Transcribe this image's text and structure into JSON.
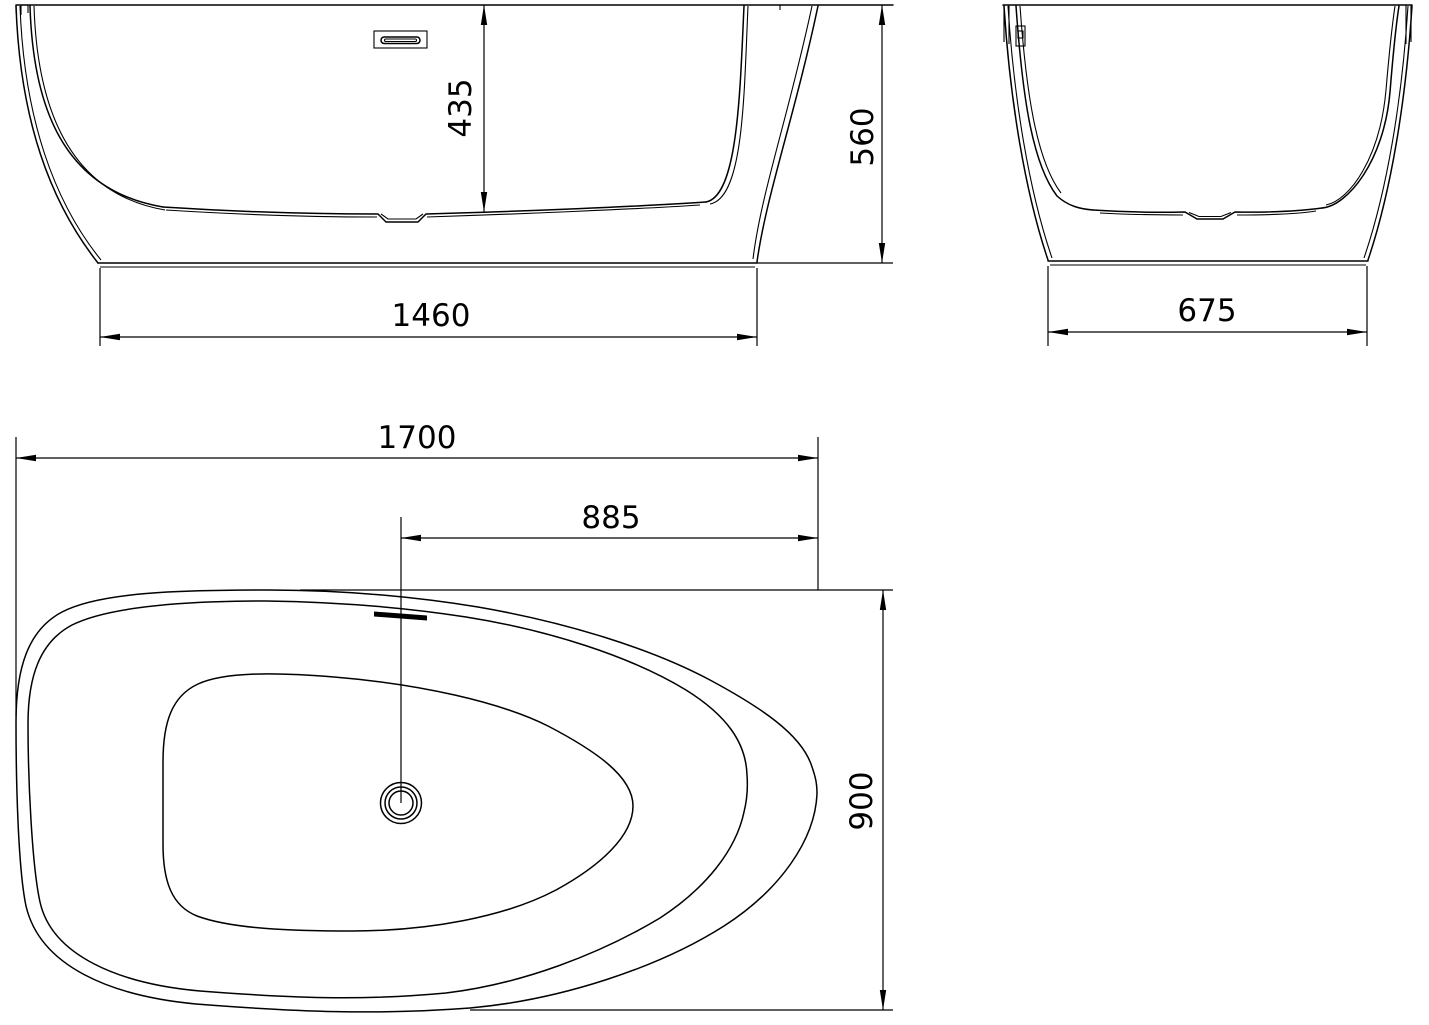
{
  "page": {
    "background": "#ffffff",
    "line_color": "#000000"
  },
  "dimensions": {
    "side_view": {
      "rim_to_floor_depth": "435",
      "overall_height": "560",
      "base_length": "1460"
    },
    "end_view": {
      "base_width": "675"
    },
    "plan_view": {
      "overall_length": "1700",
      "overflow_to_end": "885",
      "overall_width": "900"
    }
  }
}
